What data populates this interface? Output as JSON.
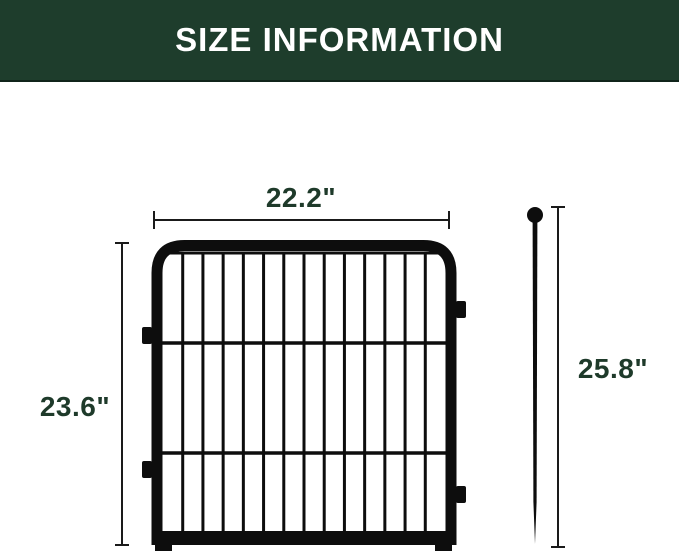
{
  "header": {
    "title": "SIZE INFORMATION"
  },
  "dimensions": {
    "panel_width": "22.2\"",
    "panel_height": "23.6\"",
    "stake_height": "25.8\""
  },
  "panel": {
    "vertical_bars": 13,
    "horizontal_wires": 2,
    "side_tabs": 4
  },
  "colors": {
    "header_bg": "#1e3d2c",
    "header_text": "#ffffff",
    "dimension_text": "#1e3a2a",
    "dimension_line": "#1a1a1a",
    "fence": "#0d0d0d",
    "background": "#ffffff"
  }
}
